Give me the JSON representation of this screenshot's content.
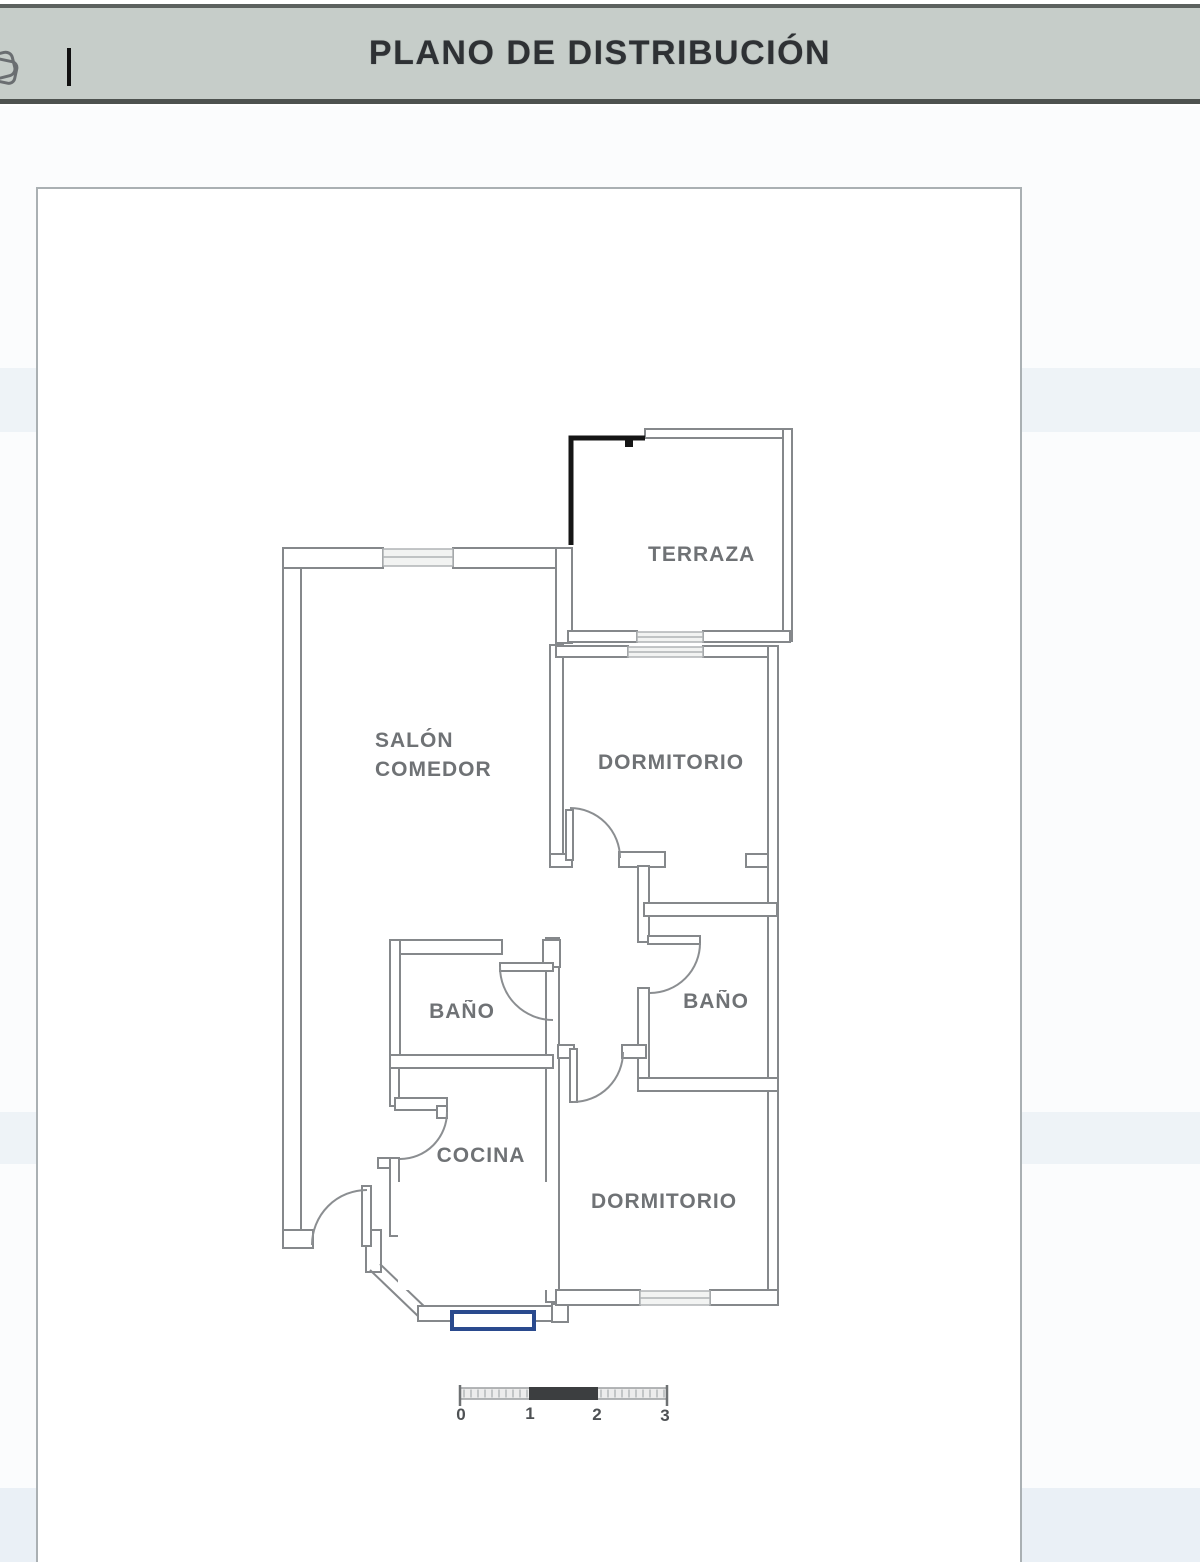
{
  "header": {
    "title": "PLANO DE DISTRIBUCIÓN",
    "bar_color": "#c6cdc9",
    "text_color": "#2e3134"
  },
  "rooms": {
    "terraza": "TERRAZA",
    "dormitorio_top": "DORMITORIO",
    "salon_line1": "SALÓN",
    "salon_line2": "COMEDOR",
    "bano_left": "BAÑO",
    "bano_right": "BAÑO",
    "cocina": "COCINA",
    "dormitorio_bottom": "DORMITORIO"
  },
  "scale_bar": {
    "labels": [
      "0",
      "1",
      "2",
      "3"
    ]
  },
  "plan": {
    "wall_color": "#85888b",
    "annotation_color": "#151515",
    "highlight_color": "#2a4a8e"
  }
}
